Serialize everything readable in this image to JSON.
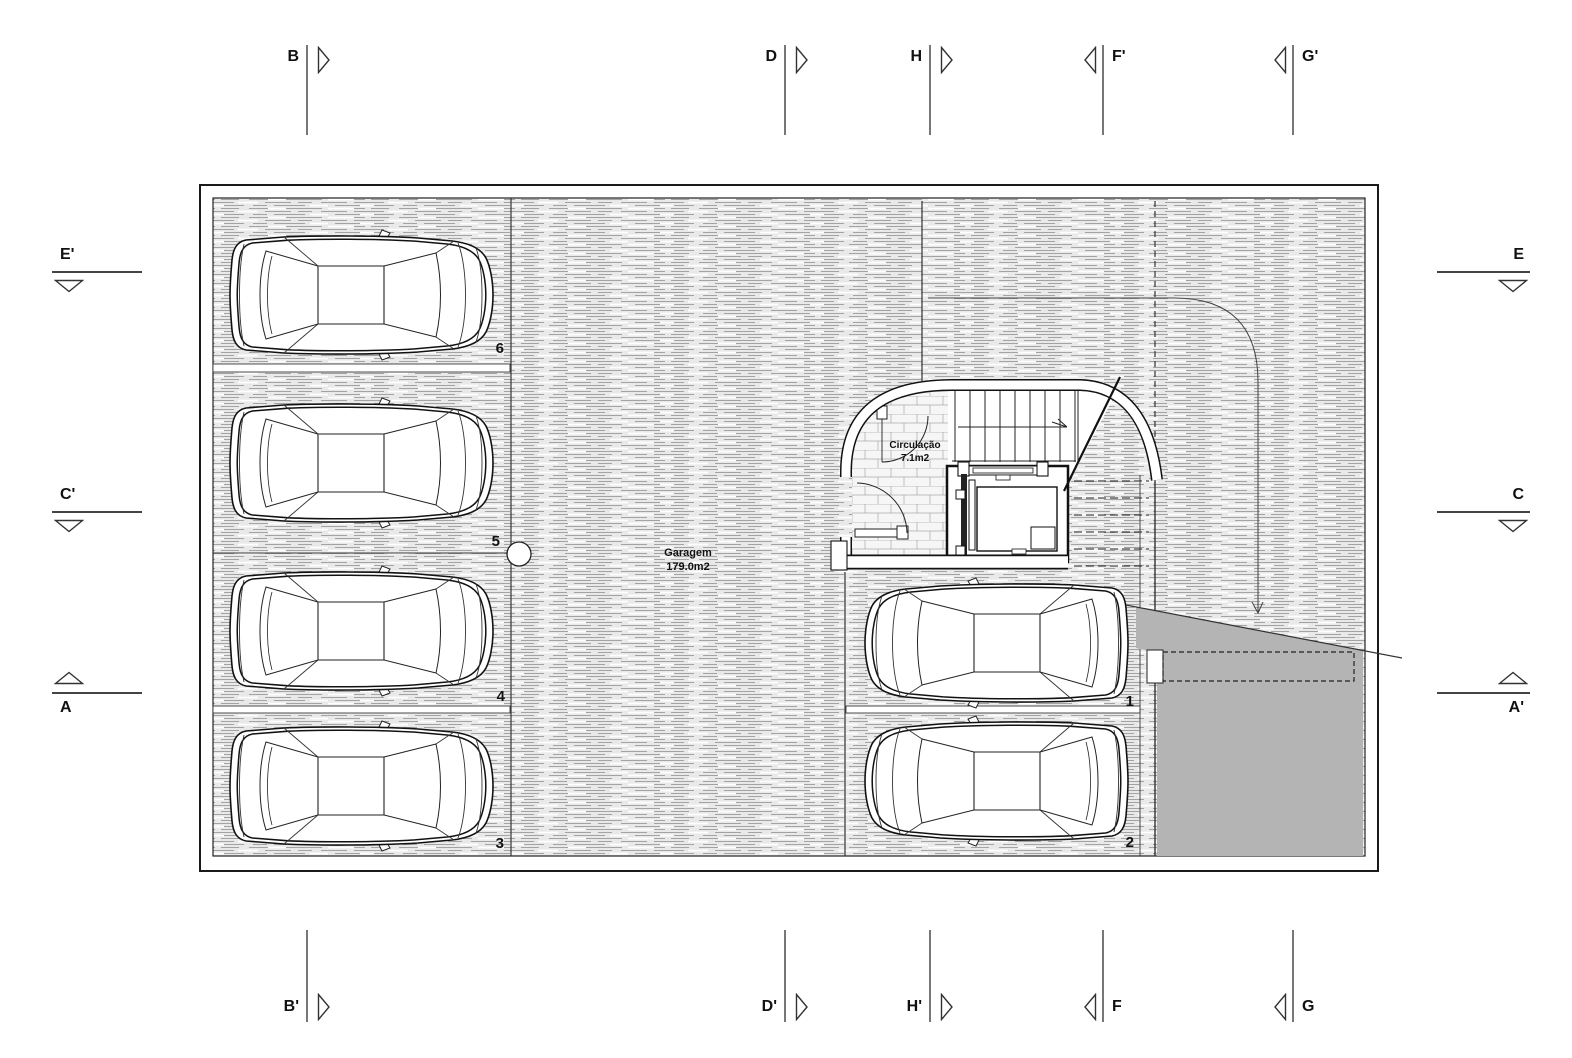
{
  "plan": {
    "garage": {
      "name": "Garagem",
      "area": "179.0m2"
    },
    "circulation": {
      "name": "Circulação",
      "area": "7.1m2"
    },
    "stalls": {
      "n1": "1",
      "n2": "2",
      "n3": "3",
      "n4": "4",
      "n5": "5",
      "n6": "6"
    }
  },
  "markers": {
    "top": [
      {
        "label": "B"
      },
      {
        "label": "D"
      },
      {
        "label": "H"
      },
      {
        "label": "F'"
      },
      {
        "label": "G'"
      }
    ],
    "bottom": [
      {
        "label": "B'"
      },
      {
        "label": "D'"
      },
      {
        "label": "H'"
      },
      {
        "label": "F"
      },
      {
        "label": "G"
      }
    ],
    "left": [
      {
        "label": "E'"
      },
      {
        "label": "C'"
      },
      {
        "label": "A"
      }
    ],
    "right": [
      {
        "label": "E"
      },
      {
        "label": "C"
      },
      {
        "label": "A'"
      }
    ]
  },
  "colors": {
    "wall_line": "#1a1a1a",
    "floor_hatch_bg": "#e9e9e9",
    "floor_hatch_line": "#a3a3a3",
    "ramp_fill": "#b4b4b4",
    "tile_bg": "#f6f6f6",
    "paper": "#ffffff"
  }
}
